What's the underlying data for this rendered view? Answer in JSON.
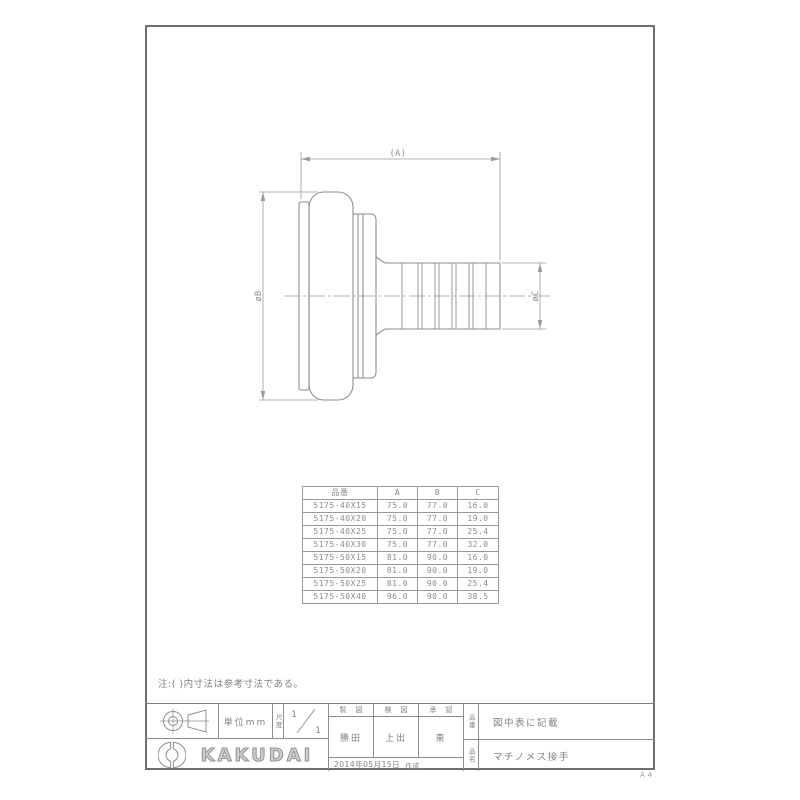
{
  "drawing": {
    "dim_a_label": "(A)",
    "dim_b_label": "øB",
    "dim_c_label": "øC"
  },
  "note": "注:( )内寸法は参考寸法である。",
  "table": {
    "headers": [
      "品番",
      "A",
      "B",
      "C"
    ],
    "rows": [
      {
        "code": "5175-40X15",
        "a": "75.0",
        "b": "77.0",
        "c": "16.0"
      },
      {
        "code": "5175-40X20",
        "a": "75.0",
        "b": "77.0",
        "c": "19.0"
      },
      {
        "code": "5175-40X25",
        "a": "75.0",
        "b": "77.0",
        "c": "25.4"
      },
      {
        "code": "5175-40X30",
        "a": "75.0",
        "b": "77.0",
        "c": "32.0"
      },
      {
        "code": "5175-50X15",
        "a": "81.0",
        "b": "90.0",
        "c": "16.0"
      },
      {
        "code": "5175-50X20",
        "a": "81.0",
        "b": "90.0",
        "c": "19.0"
      },
      {
        "code": "5175-50X25",
        "a": "81.0",
        "b": "90.0",
        "c": "25.4"
      },
      {
        "code": "5175-50X40",
        "a": "96.0",
        "b": "90.0",
        "c": "38.5"
      }
    ]
  },
  "title_block": {
    "unit_label": "単位mm",
    "scale_label": "尺度",
    "scale_numerator": "1",
    "scale_denominator": "1",
    "drafted_header": "製図",
    "checked_header": "検図",
    "approved_header": "承認",
    "drafted_name": "勝田",
    "checked_name": "上出",
    "approved_name": "東",
    "created_date": "2014年05月15日",
    "created_suffix": "作成",
    "part_no_label": "品番",
    "part_no_value": "図中表に記載",
    "part_name_label": "品名",
    "part_name_value": "マチノメス接手",
    "brand": "KAKUDAI",
    "paper_size": "A4"
  },
  "colors": {
    "outline": "#8f8f8f",
    "dimension": "#9a9a9a",
    "frame": "#6f6f6f",
    "text": "#8a8a8a"
  }
}
